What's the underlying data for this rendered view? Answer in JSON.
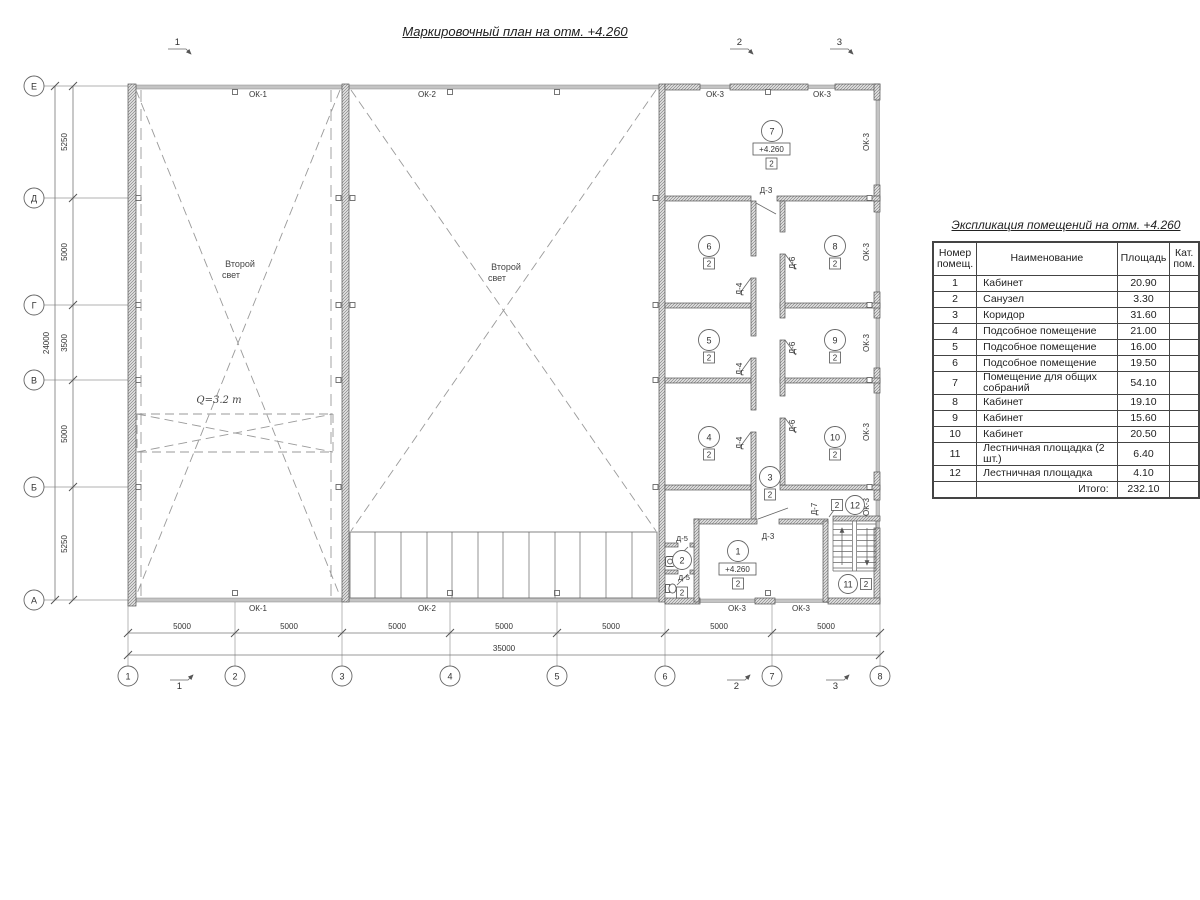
{
  "title": "Маркировочный план на отм. +4.260",
  "table": {
    "title": "Экспликация помещений на отм. +4.260",
    "header_num1": "Номер",
    "header_num2": "помещ.",
    "header_name": "Наименование",
    "header_area": "Площадь",
    "header_cat1": "Кат.",
    "header_cat2": "пом.",
    "rows": [
      {
        "num": "1",
        "name": "Кабинет",
        "area": "20.90",
        "cat": ""
      },
      {
        "num": "2",
        "name": "Санузел",
        "area": "3.30",
        "cat": ""
      },
      {
        "num": "3",
        "name": "Коридор",
        "area": "31.60",
        "cat": ""
      },
      {
        "num": "4",
        "name": "Подсобное помещение",
        "area": "21.00",
        "cat": ""
      },
      {
        "num": "5",
        "name": "Подсобное помещение",
        "area": "16.00",
        "cat": ""
      },
      {
        "num": "6",
        "name": "Подсобное помещение",
        "area": "19.50",
        "cat": ""
      },
      {
        "num": "7",
        "name": "Помещение для общих собраний",
        "area": "54.10",
        "cat": ""
      },
      {
        "num": "8",
        "name": "Кабинет",
        "area": "19.10",
        "cat": ""
      },
      {
        "num": "9",
        "name": "Кабинет",
        "area": "15.60",
        "cat": ""
      },
      {
        "num": "10",
        "name": "Кабинет",
        "area": "20.50",
        "cat": ""
      },
      {
        "num": "11",
        "name": "Лестничная площадка (2 шт.)",
        "area": "6.40",
        "cat": ""
      },
      {
        "num": "12",
        "name": "Лестничная площадка",
        "area": "4.10",
        "cat": ""
      }
    ],
    "total_label": "Итого:",
    "total_value": "232.10"
  },
  "axes": {
    "rows": [
      "Е",
      "Д",
      "Г",
      "В",
      "Б",
      "А"
    ],
    "cols": [
      "1",
      "2",
      "3",
      "4",
      "5",
      "6",
      "7",
      "8"
    ]
  },
  "dims": {
    "left_segments": [
      "5250",
      "5000",
      "3500",
      "5000",
      "5250"
    ],
    "left_total": "24000",
    "bottom_segments": [
      "5000",
      "5000",
      "5000",
      "5000",
      "5000",
      "5000",
      "5000"
    ],
    "bottom_total": "35000"
  },
  "sections": {
    "s1": "1",
    "s2": "2",
    "s3": "3"
  },
  "labels": {
    "ok1": "ОК-1",
    "ok2": "ОК-2",
    "ok3": "ОК-3",
    "d3": "Д-3",
    "d4": "Д-4",
    "d5": "Д-5",
    "d6": "Д-6",
    "d7": "Д-7",
    "cat": "2",
    "elev": "+4.260",
    "second_light_1": "Второй",
    "second_light_2": "свет",
    "crane": "Q=3.2 т"
  },
  "rooms": [
    "1",
    "2",
    "3",
    "4",
    "5",
    "6",
    "7",
    "8",
    "9",
    "10",
    "11",
    "12"
  ]
}
